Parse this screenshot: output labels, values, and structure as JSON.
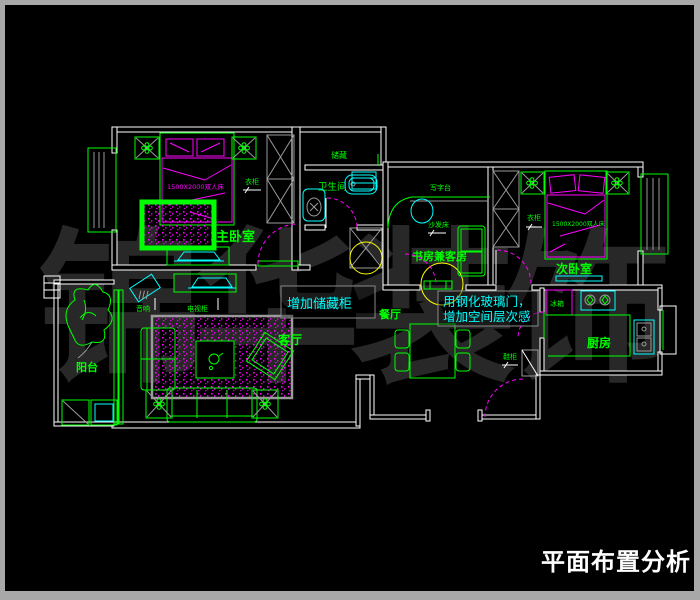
{
  "title": "平面布置分析",
  "watermark": "锦华装饰",
  "rooms": {
    "master_bedroom": "主卧室",
    "bathroom": "卫生间",
    "storage": "储藏",
    "study_guest": "书房兼客房",
    "second_bedroom": "次卧室",
    "kitchen": "厨房",
    "dining": "餐厅",
    "living": "客厅",
    "balcony": "阳台"
  },
  "furniture": {
    "wardrobe_master": "衣柜",
    "wardrobe_second": "衣柜",
    "bed_master": "1500X2000双人床",
    "bed_second": "1500X2000双人床",
    "desk": "写字台",
    "sofa_bed": "沙发床",
    "audio": "音响",
    "tv_cabinet": "电视柜",
    "shoe_cabinet": "鞋柜",
    "fridge": "冰箱"
  },
  "annotations": {
    "storage_note": "增加储藏柜",
    "glass_door_note_line1": "用钢化玻璃门，",
    "glass_door_note_line2": "增加空间层次感"
  },
  "colors": {
    "background": "#000000",
    "frame": "#a8a8a8",
    "wall": "#ffffff",
    "furniture": "#00ff00",
    "fixture": "#00ffff",
    "soft_furnishing": "#ff00ff",
    "highlight": "#ffff00",
    "hatch": "#9a9a9a",
    "watermark": "#282828",
    "annotation_text": "#00ffff",
    "title_text": "#ffffff"
  }
}
